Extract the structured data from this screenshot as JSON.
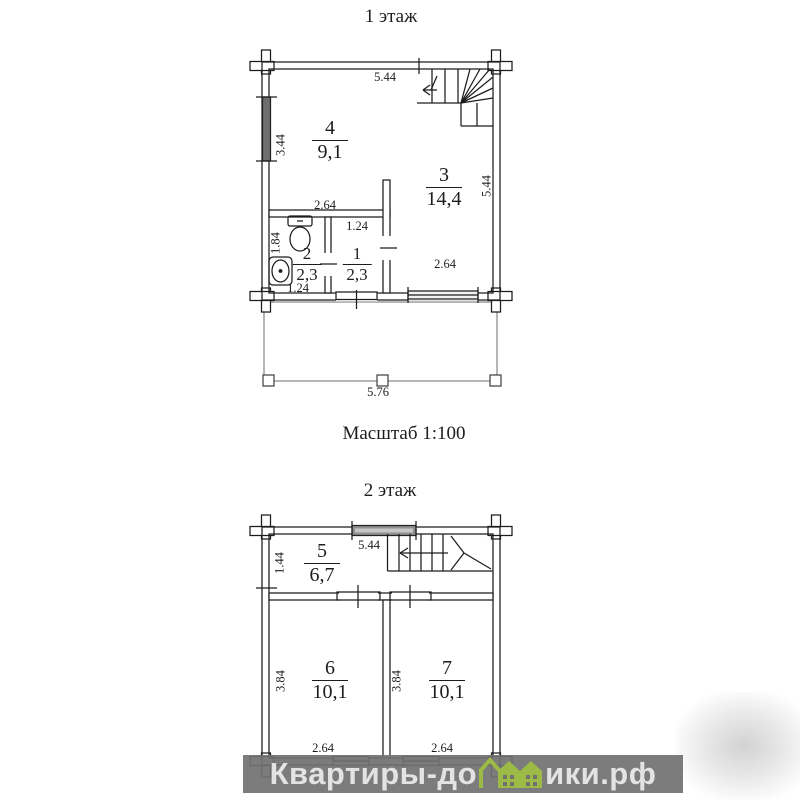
{
  "floor1": {
    "title": "1 этаж",
    "dim_top": "5.44",
    "dim_left": "3.44",
    "dim_right": "5.44",
    "dim_hall": "2.64",
    "dim_room1_top": "1.24",
    "dim_bath_height": "1.84",
    "dim_bath_width": "1.24",
    "dim_window": "2.64",
    "dim_terrace": "5.76",
    "room4_num": "4",
    "room4_area": "9,1",
    "room3_num": "3",
    "room3_area": "14,4",
    "room2_num": "2",
    "room2_area": "2,3",
    "room1_num": "1",
    "room1_area": "2,3"
  },
  "scale_label": "Масштаб 1:100",
  "floor2": {
    "title": "2 этаж",
    "dim_top": "5.44",
    "dim_left": "1.44",
    "dim_room6_h": "3.84",
    "dim_room7_h": "3.84",
    "dim_room6_w": "2.64",
    "dim_room7_w": "2.64",
    "room5_num": "5",
    "room5_area": "6,7",
    "room6_num": "6",
    "room6_area": "10,1",
    "room7_num": "7",
    "room7_area": "10,1"
  },
  "watermark": {
    "prefix": "Квартиры-до",
    "suffix": "ики.рф"
  },
  "icons": {
    "toilet": "toilet-icon",
    "sink": "sink-icon",
    "house": "house-icon"
  },
  "colors": {
    "line": "#1c1c1c",
    "window_fill": "#6e6e6e",
    "band": "#717171",
    "band_text": "#e3e3e3",
    "house_green": "#9cba46"
  }
}
